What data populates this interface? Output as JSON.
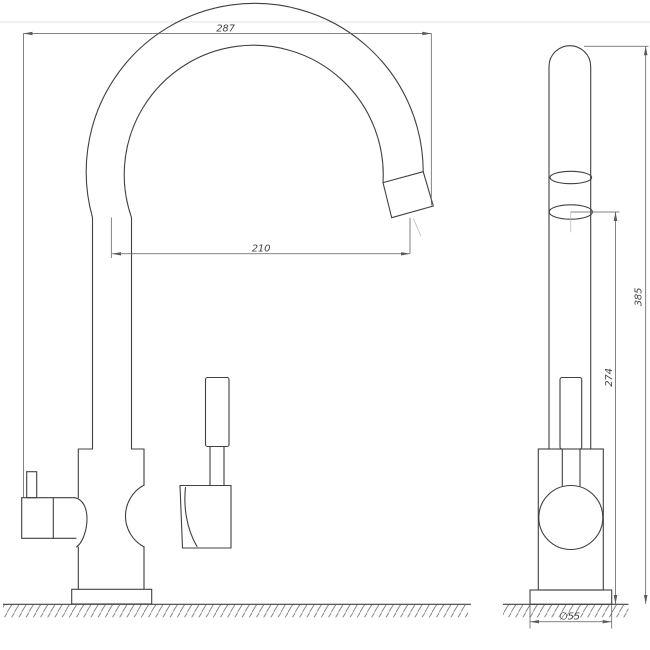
{
  "drawing": {
    "dimensions": {
      "front": {
        "overall_width": "287",
        "spout_reach": "210"
      },
      "side": {
        "overall_height": "385",
        "spout_outlet_height": "274",
        "base_diameter": "∅55"
      }
    },
    "colors": {
      "object_line": "#404040",
      "dimension_line": "#5a5a5a",
      "thin_line": "#8a8a8a",
      "light_line": "#bcbcbc",
      "border_line": "#e3e3e3",
      "background": "#ffffff"
    }
  }
}
